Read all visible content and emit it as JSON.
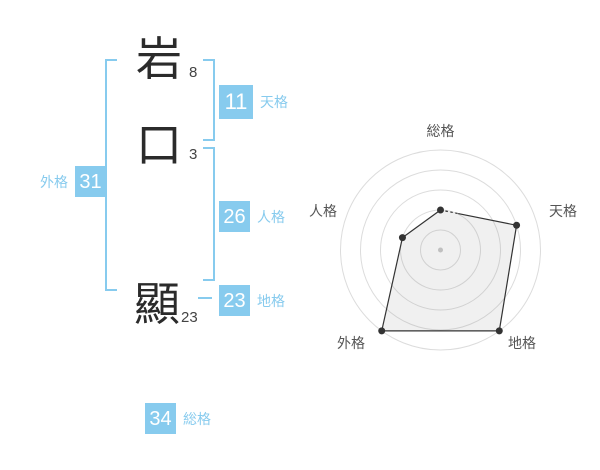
{
  "page": {
    "background": "#ffffff"
  },
  "name": {
    "accent_color": "#87cbee",
    "characters": [
      {
        "char": "岩",
        "strokes": "8"
      },
      {
        "char": "口",
        "strokes": "3"
      },
      {
        "char": "顯",
        "strokes": "23"
      }
    ],
    "categories": {
      "tenkaku": {
        "label": "天格",
        "value": "11"
      },
      "jinkaku": {
        "label": "人格",
        "value": "26"
      },
      "chikaku": {
        "label": "地格",
        "value": "23"
      },
      "gaikaku": {
        "label": "外格",
        "value": "31"
      },
      "soukaku": {
        "label": "総格",
        "value": "34"
      }
    }
  },
  "chart_data": {
    "type": "radar",
    "categories": [
      "総格",
      "天格",
      "地格",
      "外格",
      "人格"
    ],
    "values": [
      40,
      80,
      100,
      100,
      40
    ],
    "max": 100,
    "rings": 5,
    "start_axis": "top",
    "direction": "clockwise",
    "legend": "none",
    "grid_color": "#dcdcdc",
    "line_color": "#333333",
    "fill_color": "rgba(130,130,130,0.12)",
    "label_color": "#555555",
    "center_dot_color": "#c9c9c9"
  }
}
